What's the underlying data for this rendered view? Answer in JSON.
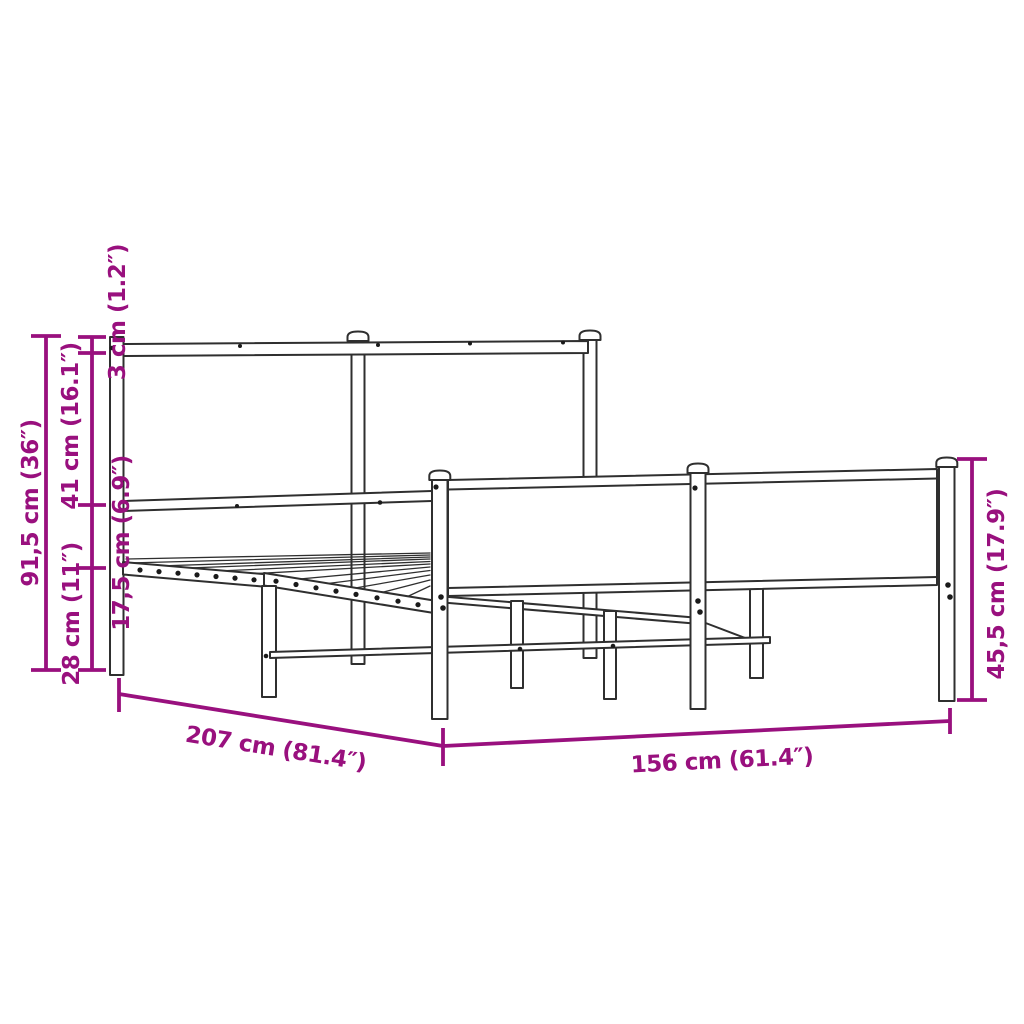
{
  "figure": {
    "kind": "product-dimension-diagram",
    "background_color": "#ffffff",
    "drawing_color": "#2f2f2f",
    "dimension_color": "#99107E"
  },
  "dimensions": [
    {
      "id": "overall-height",
      "label": "91,5 cm (36″)",
      "cm": "91,5",
      "inches": "36",
      "orientation": "vertical"
    },
    {
      "id": "headboard-upper",
      "label": "41 cm (16.1″)",
      "cm": "41",
      "inches": "16.1",
      "orientation": "vertical"
    },
    {
      "id": "ground-clearance",
      "label": "28 cm (11″)",
      "cm": "28",
      "inches": "11",
      "orientation": "vertical"
    },
    {
      "id": "top-rail",
      "label": "3 cm (1.2″)",
      "cm": "3",
      "inches": "1.2",
      "orientation": "vertical"
    },
    {
      "id": "side-rail-height",
      "label": "17,5 cm (6.9″)",
      "cm": "17,5",
      "inches": "6.9",
      "orientation": "vertical"
    },
    {
      "id": "length",
      "label": "207 cm (81.4″)",
      "cm": "207",
      "inches": "81.4",
      "orientation": "diagonal"
    },
    {
      "id": "width",
      "label": "156 cm (61.4″)",
      "cm": "156",
      "inches": "61.4",
      "orientation": "horizontal"
    },
    {
      "id": "footboard-height",
      "label": "45,5 cm (17.9″)",
      "cm": "45,5",
      "inches": "17.9",
      "orientation": "vertical"
    }
  ]
}
